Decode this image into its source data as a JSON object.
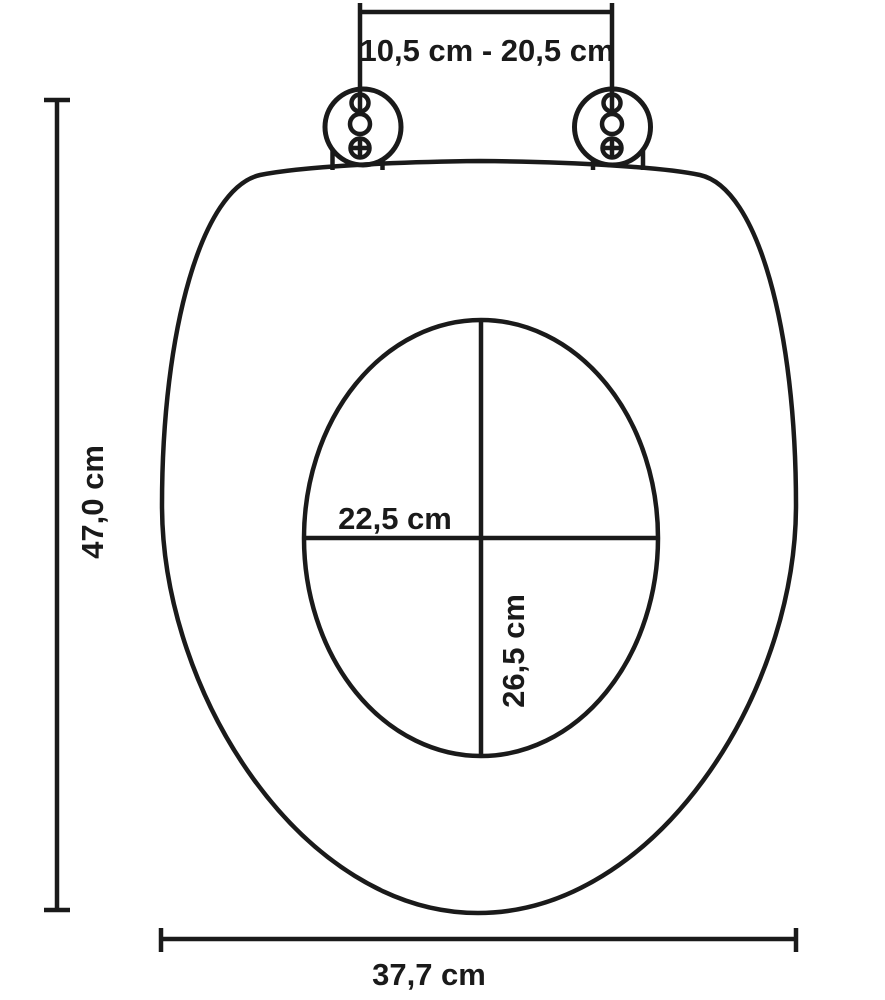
{
  "diagram": {
    "title": "Toilet seat dimension drawing",
    "colors": {
      "line": "#1a1a1a",
      "background": "#ffffff"
    },
    "dimensions": {
      "hinge_distance": {
        "label": "10,5 cm - 20,5 cm"
      },
      "total_length": {
        "label": "47,0 cm"
      },
      "inner_width": {
        "label": "22,5 cm"
      },
      "inner_length": {
        "label": "26,5 cm"
      },
      "total_width": {
        "label": "37,7 cm"
      }
    }
  }
}
